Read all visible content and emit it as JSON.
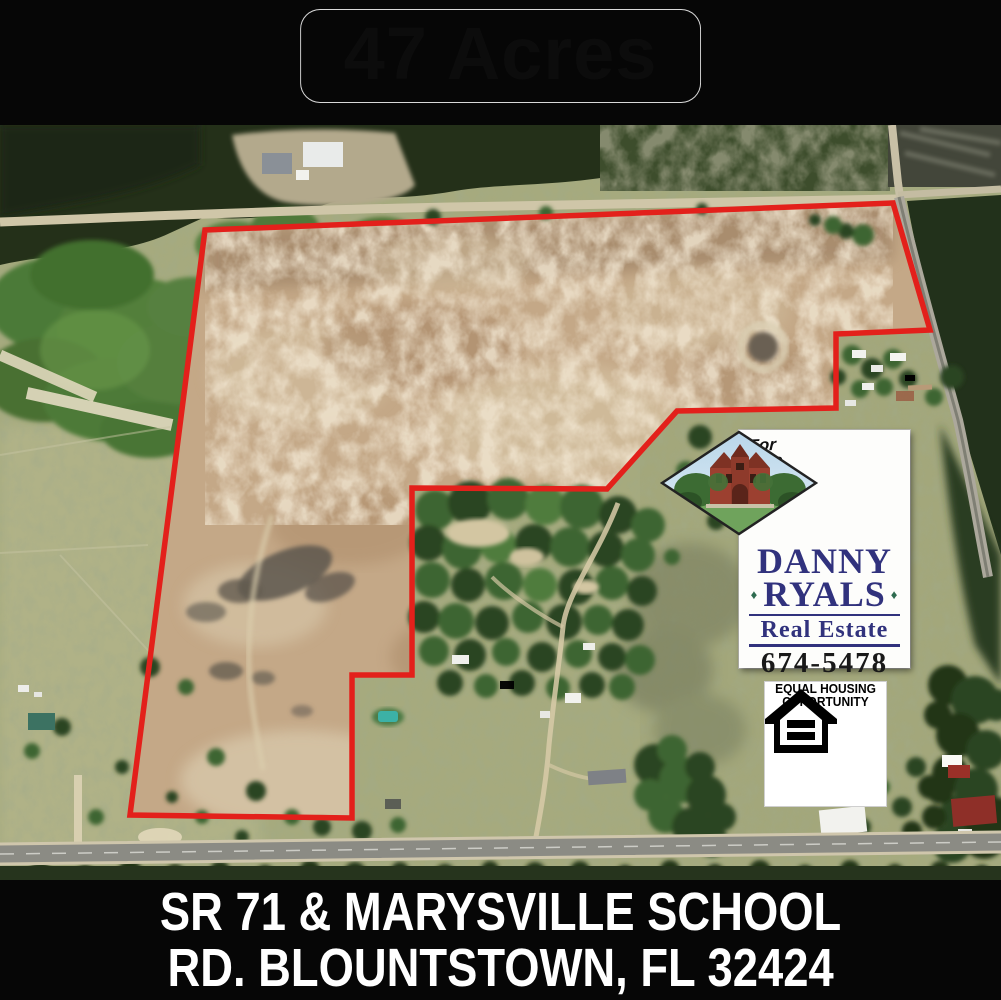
{
  "banner": {
    "acreage": "47 Acres"
  },
  "photo": {
    "description": "aerial view of cleared 47 acre parcel outlined in red",
    "boundary_color": "#e3201b"
  },
  "sale_sign": {
    "for_sale": "For Sale",
    "broker_first": "DANNY",
    "broker_last": "RYALS",
    "bullet": "♦",
    "company": "Real Estate",
    "phone": "674-5478",
    "accent_color": "#31327d"
  },
  "equal_housing": {
    "line1": "EQUAL HOUSING",
    "line2": "OPPORTUNITY"
  },
  "address": {
    "line1": "SR 71 & MARYSVILLE SCHOOL",
    "line2": "RD. BLOUNTSTOWN, FL 32424"
  }
}
